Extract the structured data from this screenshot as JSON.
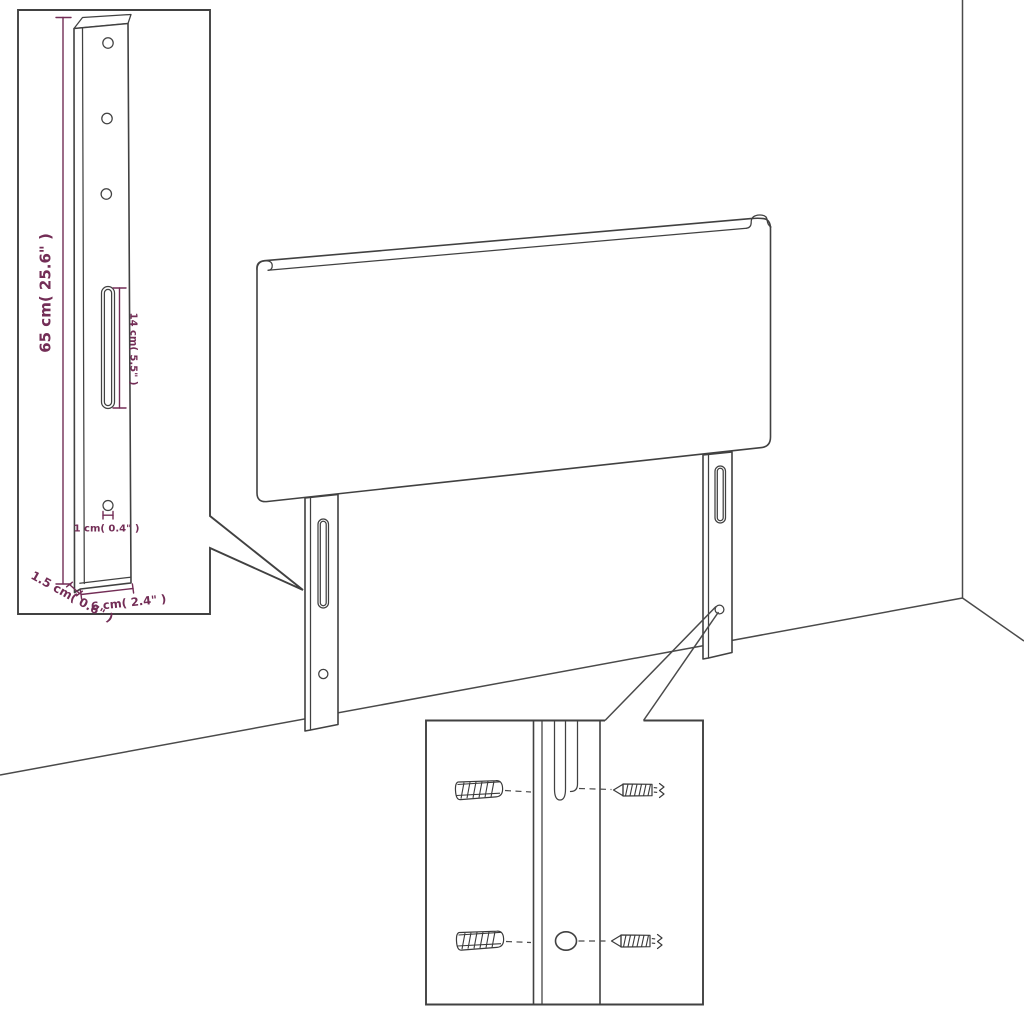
{
  "figure": {
    "kind": "headboard dimension diagram"
  },
  "colors": {
    "background": "#ffffff",
    "line_art": "#414141",
    "dimension": "#732d56"
  },
  "dimensions": {
    "leg_height": "65 cm( 25.6\" )",
    "slot_length": "14 cm( 5.5\" )",
    "hole_diameter": "1 cm( 0.4\" )",
    "leg_thickness": "1.5 cm( 0.6\" )",
    "leg_width": "6 cm( 2.4\" )"
  }
}
